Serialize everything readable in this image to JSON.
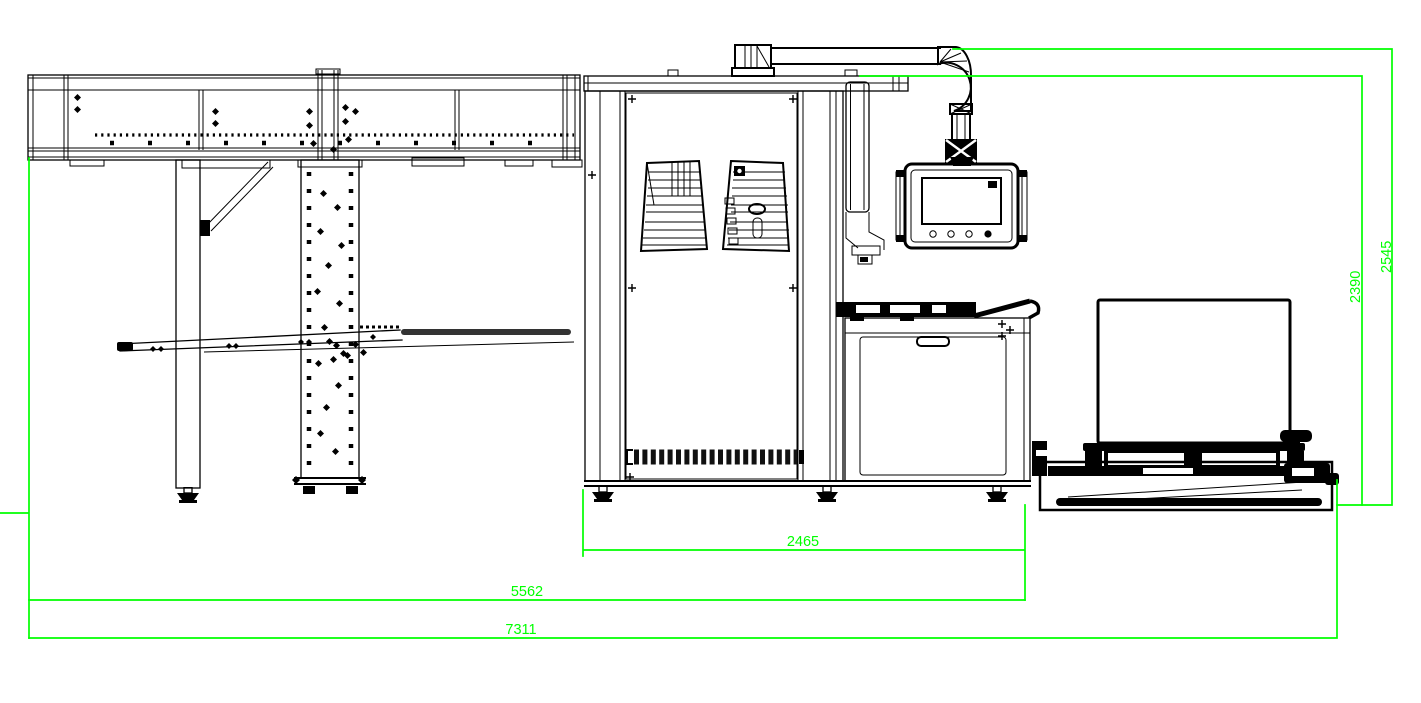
{
  "drawing": {
    "type": "machine-layout-side-view-cad",
    "colors": {
      "background": "#ffffff",
      "linework": "#000000",
      "dimension": "#00ff00"
    },
    "dimensions": {
      "d2465": "2465",
      "d5562": "5562",
      "d7311": "7311",
      "d2390": "2390",
      "d2545": "2545"
    }
  }
}
